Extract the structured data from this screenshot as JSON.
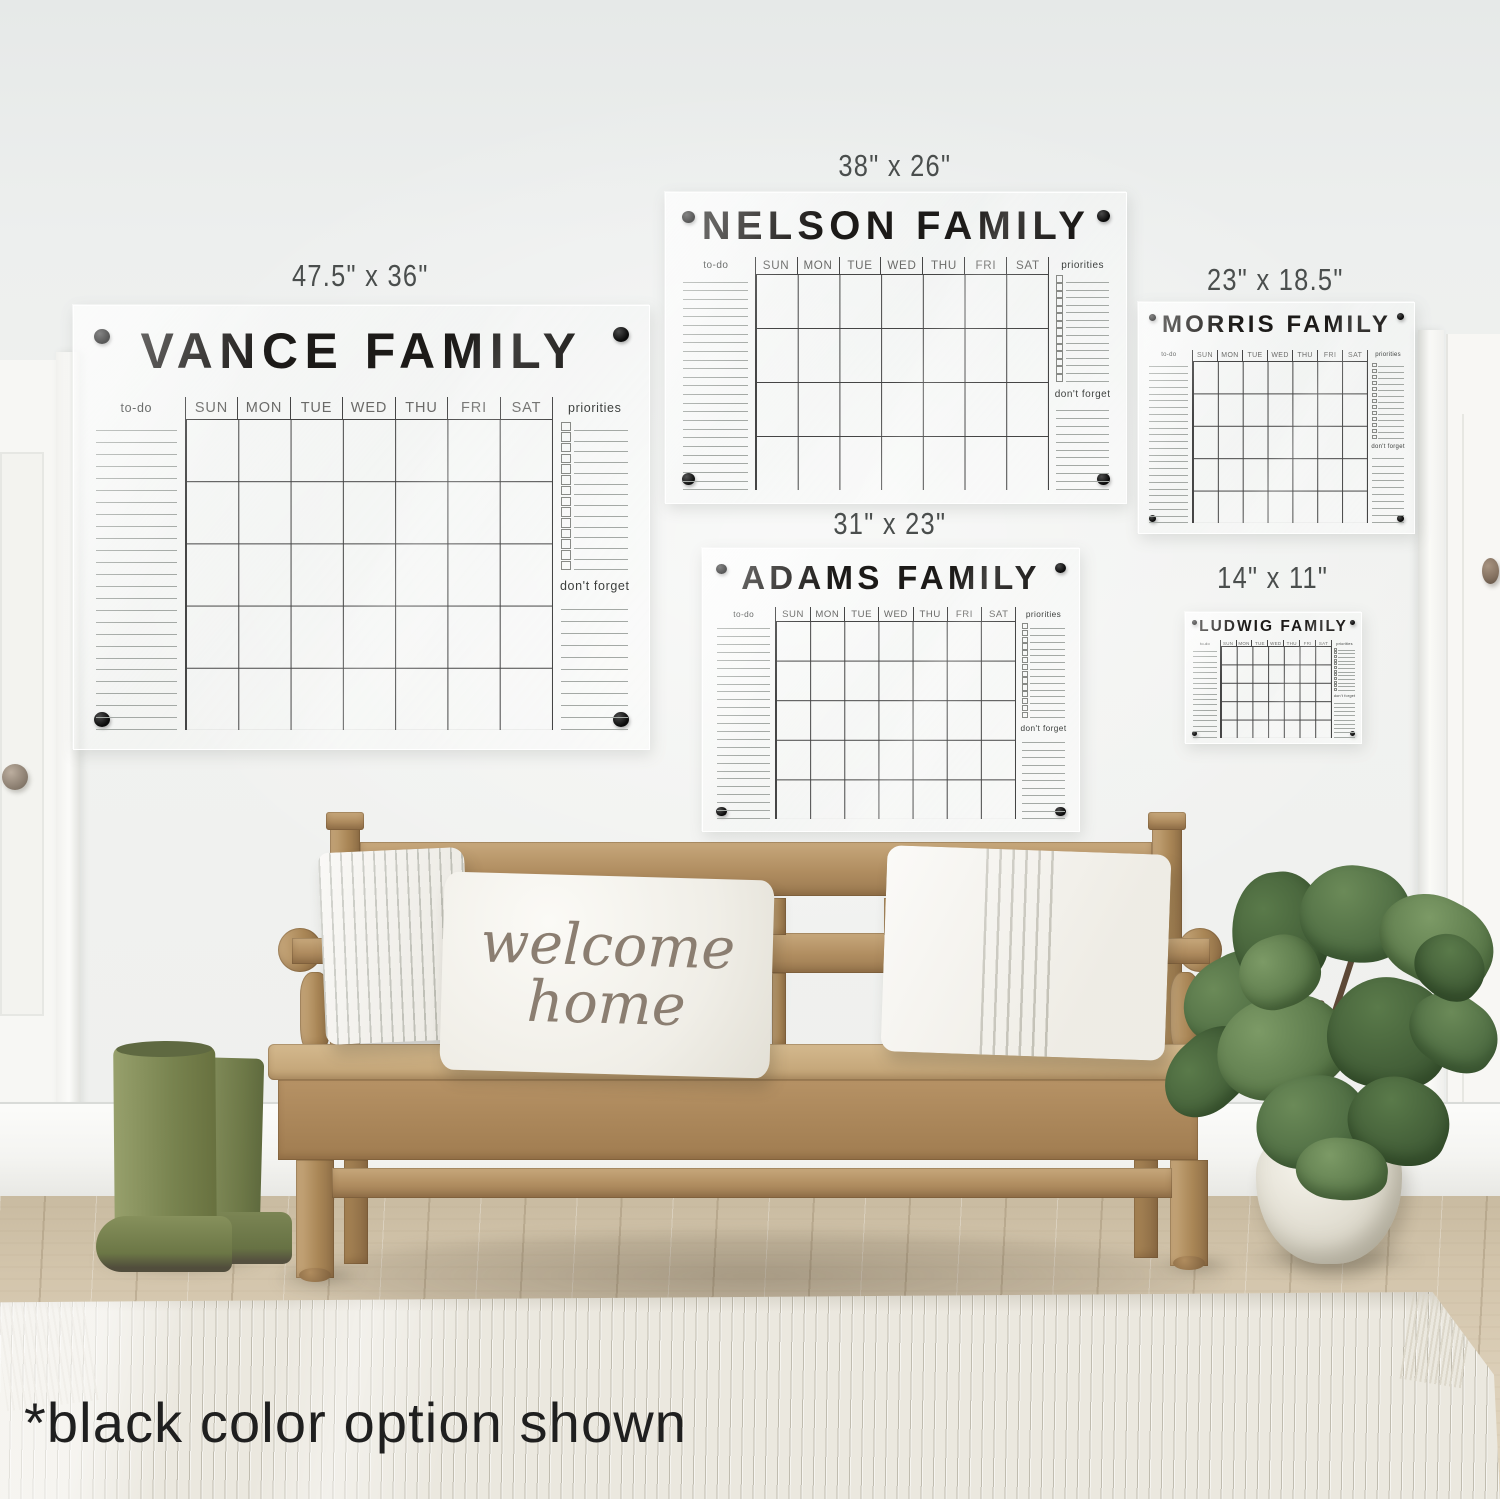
{
  "scene": {
    "annotation": "*black color option shown",
    "pillow_line1": "welcome",
    "pillow_line2": "home"
  },
  "shared": {
    "todo_label": "to-do",
    "priorities_label": "priorities",
    "dont_forget_label": "don't forget",
    "days": [
      "SUN",
      "MON",
      "TUE",
      "WED",
      "THU",
      "FRI",
      "SAT"
    ]
  },
  "calendars": [
    {
      "id": "vance",
      "title": "VANCE FAMILY",
      "size": "47.5\" x 36\""
    },
    {
      "id": "nelson",
      "title": "NELSON FAMILY",
      "size": "38\" x 26\""
    },
    {
      "id": "adams",
      "title": "ADAMS FAMILY",
      "size": "31\" x 23\""
    },
    {
      "id": "morris",
      "title": "MORRIS FAMILY",
      "size": "23\" x 18.5\""
    },
    {
      "id": "ludwig",
      "title": "LUDWIG FAMILY",
      "size": "14\" x 11\""
    }
  ],
  "colors": {
    "vinyl_black": "#141414",
    "grid_line": "#454545",
    "ruled_line": "#a4a9a5",
    "wall": "#eff1ef",
    "bench_wood": "#b08d60",
    "floor_wood": "#d3c5ac",
    "rug": "#ebe8df",
    "boots_green": "#78834f",
    "leaf_green": "#4b6940",
    "pot_white": "#e8e6db",
    "pillow_white": "#f6f4ef",
    "pillow_script": "#8b7e71"
  }
}
